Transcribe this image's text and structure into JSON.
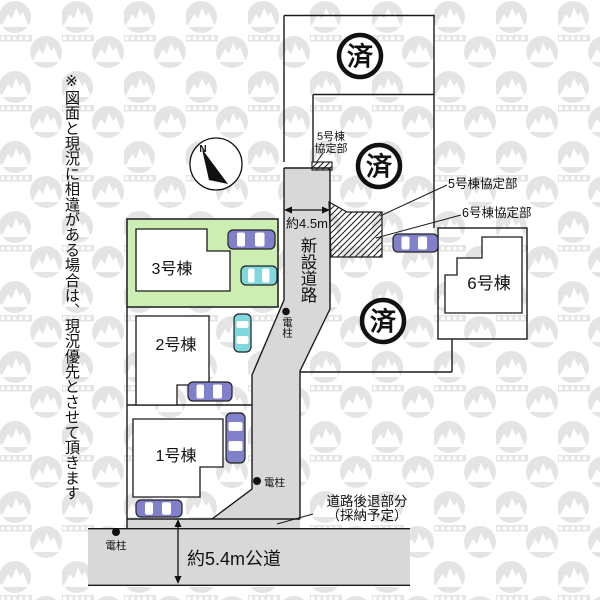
{
  "disclaimer": "※図面と現況に相違がある場合は、現況優先とさせて頂きます",
  "compass": {
    "north": "N"
  },
  "lots": {
    "lot1": {
      "label": "1号棟"
    },
    "lot2": {
      "label": "2号棟"
    },
    "lot3": {
      "label": "3号棟"
    },
    "lot6": {
      "label": "6号棟"
    },
    "sold_mark": "済"
  },
  "roads": {
    "new_road": {
      "label": "新設道路",
      "width": "約4.5m"
    },
    "public_road": {
      "label": "約5.4m公道"
    },
    "setback": {
      "line1": "道路後退部分",
      "line2": "（採納予定）"
    }
  },
  "agreements": {
    "corner_label": {
      "line1": "5号棟",
      "line2": "協定部"
    },
    "label_lot5": "5号棟協定部",
    "label_lot6": "6号棟協定部"
  },
  "utility_pole": {
    "label": "電柱"
  },
  "colors": {
    "lot_green": "#cdeeb2",
    "road_gray": "#d8d8d8",
    "car_purple": "#8080cb",
    "car_cyan": "#7ed8dd",
    "outline": "#1a1a1a",
    "watermark_gray": "#e4e4e4"
  }
}
